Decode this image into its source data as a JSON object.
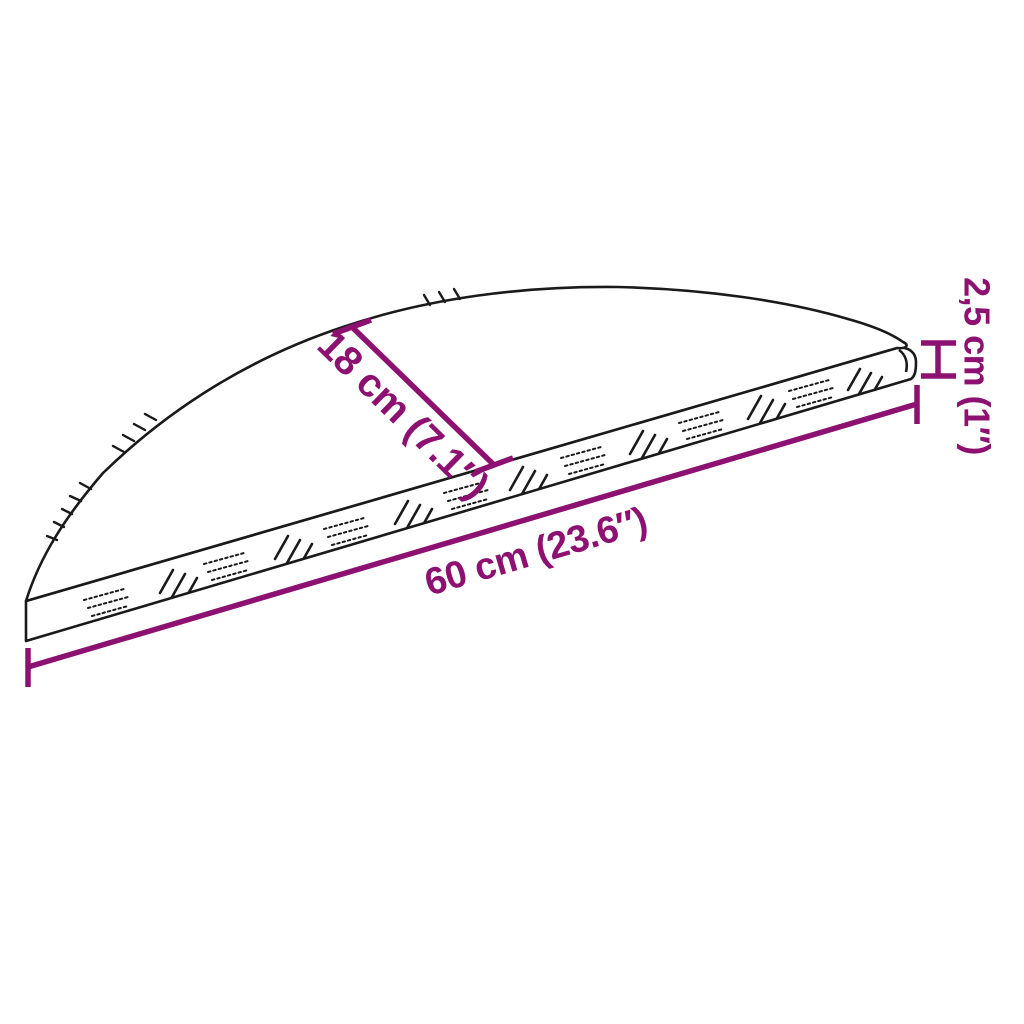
{
  "diagram": {
    "subject": "semicircular-checker-plate-stair-tread",
    "background_color": "#ffffff",
    "outline_color": "#1a1a1a",
    "accent_color": "#8D1171",
    "labels": {
      "depth": "18 cm (7.1″)",
      "width": "60 cm (23.6″)",
      "thickness": "2,5 cm (1″)"
    }
  }
}
